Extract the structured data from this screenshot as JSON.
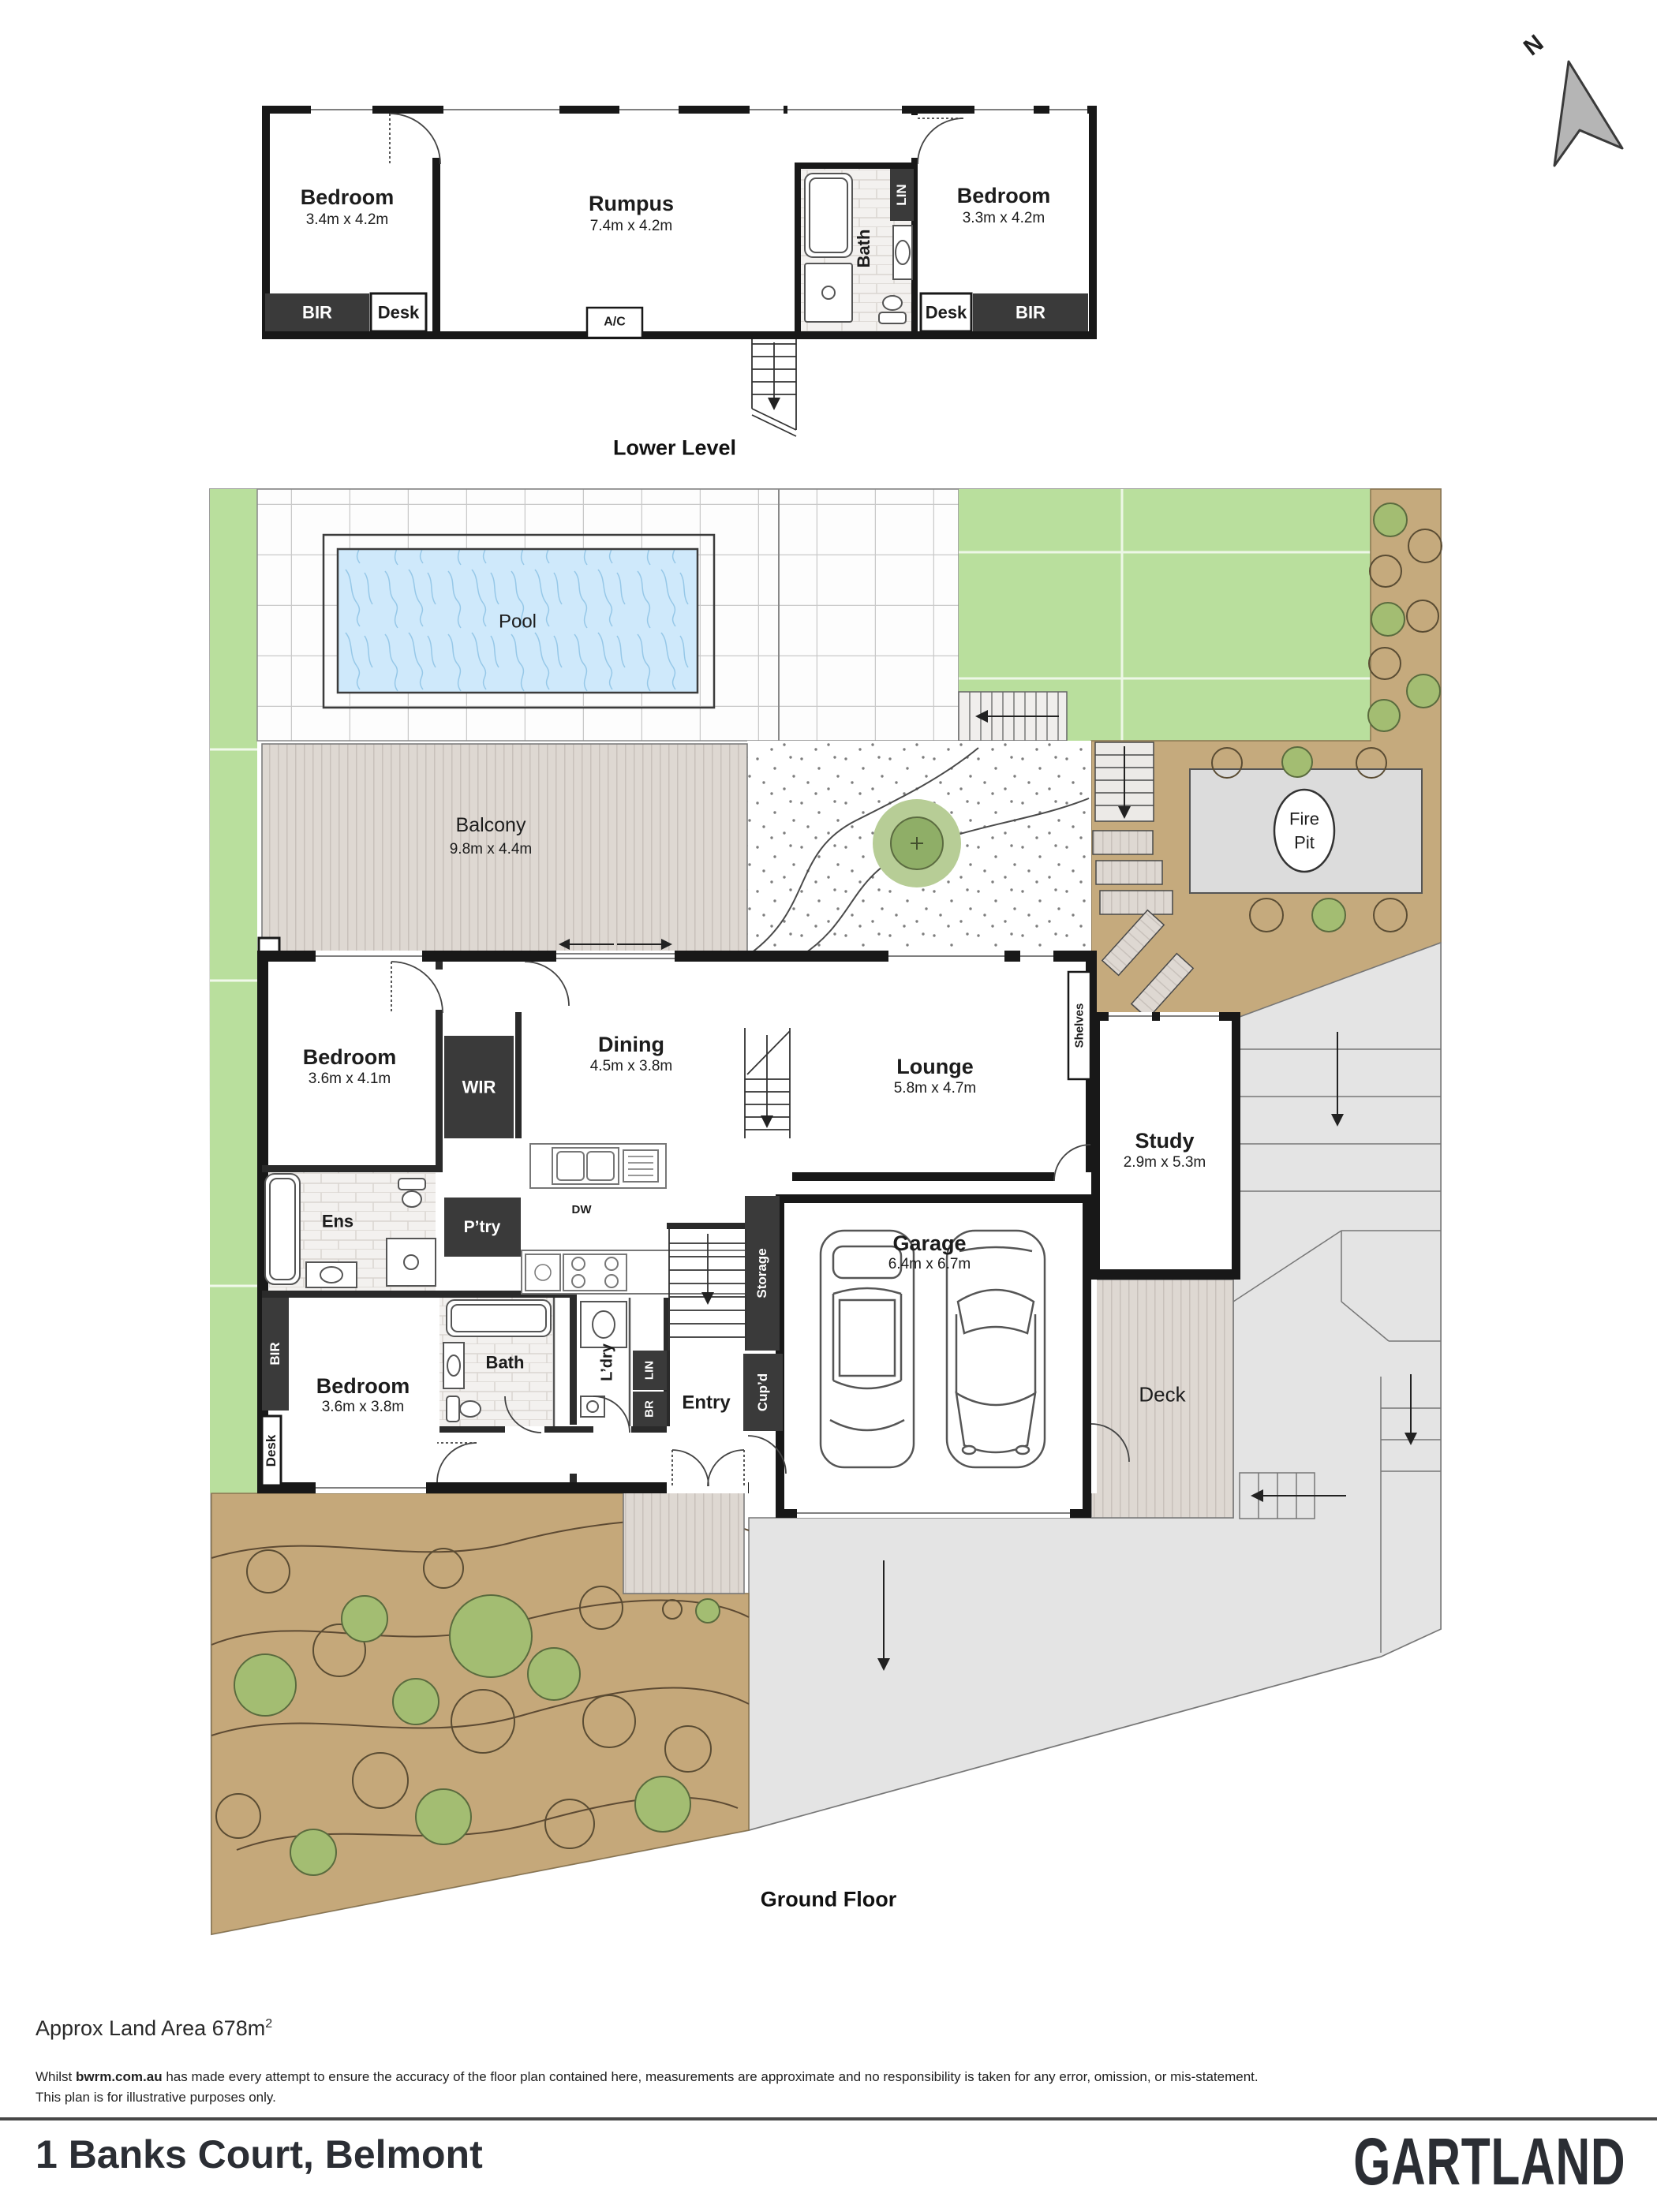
{
  "north": {
    "label": "N"
  },
  "lower": {
    "bedroom_left": "Bedroom",
    "bedroom_left_dims": "3.4m x 4.2m",
    "rumpus": "Rumpus",
    "rumpus_dims": "7.4m x 4.2m",
    "bath": "Bath",
    "lin": "LIN",
    "bedroom_right": "Bedroom",
    "bedroom_right_dims": "3.3m x 4.2m",
    "bir_left": "BIR",
    "desk_left": "Desk",
    "ac": "A/C",
    "desk_right": "Desk",
    "bir_right": "BIR",
    "caption": "Lower Level"
  },
  "ground": {
    "pool": "Pool",
    "balcony": "Balcony",
    "balcony_dims": "9.8m x 4.4m",
    "fire_pit_1": "Fire",
    "fire_pit_2": "Pit",
    "bedroom_upper": "Bedroom",
    "bedroom_upper_dims": "3.6m x 4.1m",
    "wir": "WIR",
    "dining": "Dining",
    "dining_dims": "4.5m x 3.8m",
    "lounge": "Lounge",
    "lounge_dims": "5.8m x 4.7m",
    "shelves": "Shelves",
    "study": "Study",
    "study_dims": "2.9m x 5.3m",
    "ens": "Ens",
    "ptry": "P’try",
    "dw": "DW",
    "storage": "Storage",
    "cupd": "Cup’d",
    "garage": "Garage",
    "garage_dims": "6.4m x 6.7m",
    "bedroom_lower": "Bedroom",
    "bedroom_lower_dims": "3.6m x 3.8m",
    "bath": "Bath",
    "ldry": "L’dry",
    "br": "BR",
    "lin": "LIN",
    "entry": "Entry",
    "deck": "Deck",
    "bir": "BIR",
    "desk": "Desk",
    "caption": "Ground Floor"
  },
  "footer": {
    "land_area": "Approx Land Area 678m",
    "land_area_sup": "2",
    "disclaimer_pre": "Whilst ",
    "disclaimer_brand": "bwrm.com.au",
    "disclaimer_post": " has made every attempt to ensure the accuracy of the floor plan contained here, measurements are approximate and no responsibility is taken for any error, omission, or mis-statement.",
    "disclaimer_line2": "This plan is for illustrative purposes only.",
    "address": "1 Banks Court, Belmont",
    "brand": "GARTLAND"
  },
  "colors": {
    "wall": "#181818",
    "dark_fitting": "#3a3a3a",
    "lawn": "#b9df9d",
    "tan": "#c5aa7d",
    "pool": "#cfe9fb",
    "deck": "#ded8d2",
    "platform": "#dcdcdc",
    "driveway": "#e4e4e4",
    "shrub": "#a3bd72"
  }
}
